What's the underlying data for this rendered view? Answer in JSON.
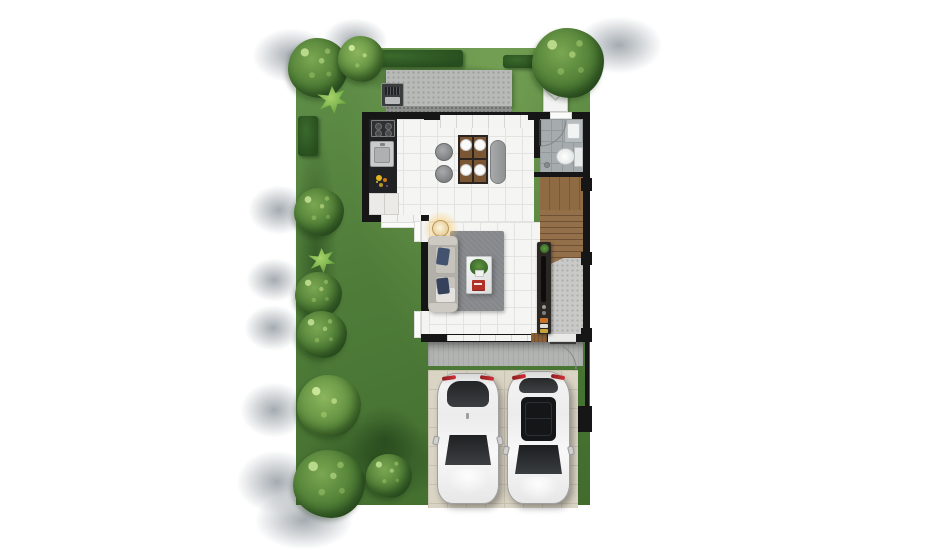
{
  "scene": {
    "type": "residential ground-floor plan, top-down 3D render",
    "background_color": "#ffffff",
    "garden": {
      "lawn_color": "#4f7d39",
      "hedge_color": "#2d5523",
      "tree_count": 9,
      "spiky_plant_count": 2,
      "cast_shadow_color": "#949ca3"
    },
    "house": {
      "wall_color": "#161616",
      "rooms": [
        {
          "name": "outdoor-patio",
          "floor": "concrete slab",
          "items": [
            "bbq-grill",
            "pebble-border"
          ]
        },
        {
          "name": "kitchen-dining",
          "floor": "white ceramic tile",
          "items": [
            "kitchen-counter",
            "cooktop",
            "kitchen-sink",
            "flower-vase",
            "base-cabinet",
            "dining-table",
            "four-plates",
            "dining-chair",
            "dining-chair",
            "dining-bench"
          ]
        },
        {
          "name": "living-room",
          "floor": "white ceramic tile",
          "items": [
            "sofa",
            "navy-pillows",
            "floor-lamp",
            "gray-area-rug",
            "coffee-table",
            "potted-plant",
            "red-books",
            "tv-console",
            "television"
          ]
        },
        {
          "name": "bathroom",
          "floor": "gray tile",
          "items": [
            "wash-basin",
            "toilet",
            "floor-drain",
            "swing-door",
            "window"
          ]
        },
        {
          "name": "staircase",
          "floor": "wood",
          "items": [
            "landing",
            "treads",
            "under-stair-concrete"
          ]
        },
        {
          "name": "entry-porch",
          "floor": "concrete tile",
          "items": [
            "entry-door",
            "door-swing",
            "doormat"
          ]
        },
        {
          "name": "carport",
          "floor": "beige tile",
          "items": [
            "car",
            "car"
          ]
        }
      ],
      "equipment": [
        {
          "name": "ac-condenser-unit",
          "color": "#f2f3f2"
        }
      ]
    },
    "vehicles": [
      {
        "name": "car-left",
        "body_color": "#f2f2f2",
        "glass_color": "#2c2e30",
        "accent_color": "#c02a2e",
        "roof": "solid"
      },
      {
        "name": "car-right",
        "body_color": "#f4f4f4",
        "glass_color": "#141617",
        "accent_color": "#c02a2e",
        "roof": "panoramic-sunroof"
      }
    ],
    "palette": {
      "white_tile": "#f5f5f3",
      "bath_tile": "#a6abad",
      "garage_tile": "#dad4c4",
      "concrete": "#b8bab8",
      "wood": "#8f6b44",
      "rug": "#85878a",
      "sofa": "#c2bfb9",
      "pillow_navy": "#43536f",
      "table_wood": "#7b5634",
      "lamp_glow": "#f3c66a"
    }
  }
}
